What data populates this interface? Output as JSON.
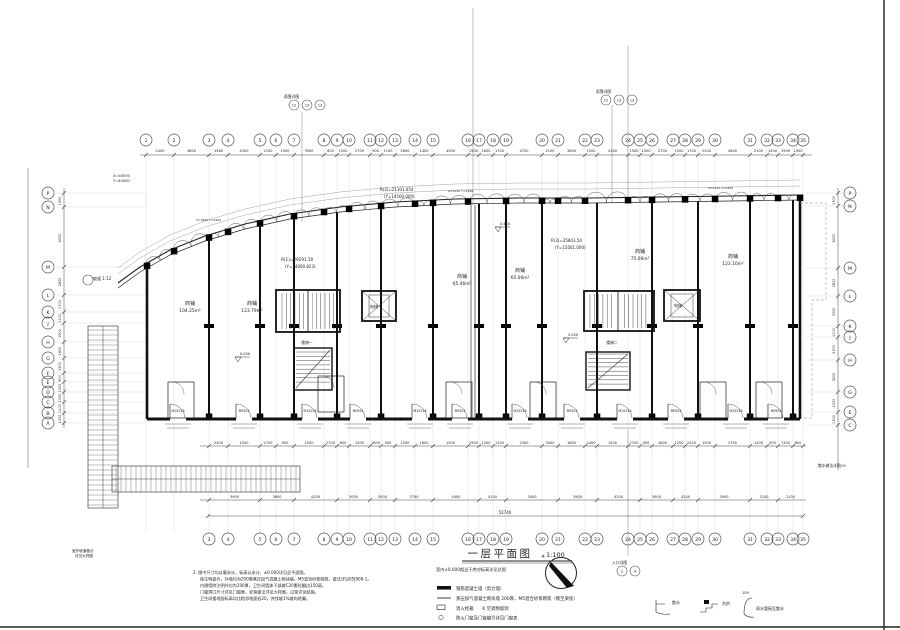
{
  "title": {
    "text": "一层平面图",
    "scale": "1:100",
    "subtitle": "室内±0.000相当于绝对标高详见总图",
    "total_dim": "52740"
  },
  "north": {
    "mark": "✳"
  },
  "grid": {
    "top": [
      {
        "n": "1",
        "x": 146
      },
      {
        "n": "2",
        "x": 174
      },
      {
        "n": "3",
        "x": 209
      },
      {
        "n": "4",
        "x": 228
      },
      {
        "n": "5",
        "x": 260
      },
      {
        "n": "6",
        "x": 276
      },
      {
        "n": "7",
        "x": 294
      },
      {
        "n": "8",
        "x": 324
      },
      {
        "n": "9",
        "x": 337
      },
      {
        "n": "10",
        "x": 349
      },
      {
        "n": "11",
        "x": 370
      },
      {
        "n": "12",
        "x": 381
      },
      {
        "n": "13",
        "x": 395
      },
      {
        "n": "14",
        "x": 415
      },
      {
        "n": "15",
        "x": 433
      },
      {
        "n": "16",
        "x": 468
      },
      {
        "n": "17",
        "x": 479
      },
      {
        "n": "18",
        "x": 493
      },
      {
        "n": "19",
        "x": 506
      },
      {
        "n": "20",
        "x": 542
      },
      {
        "n": "21",
        "x": 558
      },
      {
        "n": "22",
        "x": 585
      },
      {
        "n": "23",
        "x": 597
      },
      {
        "n": "24",
        "x": 628
      },
      {
        "n": "25",
        "x": 640
      },
      {
        "n": "26",
        "x": 652
      },
      {
        "n": "27",
        "x": 673
      },
      {
        "n": "28",
        "x": 685
      },
      {
        "n": "29",
        "x": 698
      },
      {
        "n": "30",
        "x": 715
      },
      {
        "n": "31",
        "x": 750
      },
      {
        "n": "32",
        "x": 767
      },
      {
        "n": "33",
        "x": 778
      },
      {
        "n": "34",
        "x": 793
      },
      {
        "n": "35",
        "x": 803
      }
    ],
    "left": [
      {
        "n": "P",
        "y": 193
      },
      {
        "n": "N",
        "y": 207
      },
      {
        "n": "M",
        "y": 267
      },
      {
        "n": "L",
        "y": 295
      },
      {
        "n": "K",
        "y": 312
      },
      {
        "n": "J",
        "y": 323
      },
      {
        "n": "H",
        "y": 342
      },
      {
        "n": "G",
        "y": 358
      },
      {
        "n": "F",
        "y": 373
      },
      {
        "n": "E",
        "y": 382
      },
      {
        "n": "D",
        "y": 392
      },
      {
        "n": "C",
        "y": 402
      },
      {
        "n": "B",
        "y": 413
      },
      {
        "n": "A",
        "y": 423
      }
    ],
    "right": [
      {
        "n": "P",
        "y": 193
      },
      {
        "n": "N",
        "y": 206
      },
      {
        "n": "M",
        "y": 268
      },
      {
        "n": "L",
        "y": 296
      },
      {
        "n": "K",
        "y": 326
      },
      {
        "n": "J",
        "y": 337
      },
      {
        "n": "H",
        "y": 360
      },
      {
        "n": "G",
        "y": 392
      },
      {
        "n": "E",
        "y": 412
      },
      {
        "n": "C",
        "y": 425
      }
    ]
  },
  "dims": {
    "top": [
      "2400",
      "4800",
      "1560",
      "4300",
      "2100",
      "1500",
      "3900",
      "600",
      "1500",
      "2700",
      "900",
      "1100",
      "2600",
      "1400",
      "4500",
      "1500",
      "1800",
      "1700",
      "4700",
      "2100",
      "3600",
      "1500",
      "4100",
      "1500",
      "1500",
      "2700",
      "1500",
      "1700",
      "2200",
      "4600",
      "2100",
      "1400",
      "1900",
      "1300"
    ],
    "bottom1": [
      "2400",
      "1500",
      "2700",
      "900",
      "1500",
      "2700",
      "600",
      "1200",
      "1800",
      "900",
      "1200",
      "1800",
      "1500",
      "2900",
      "1200",
      "1100",
      "2300",
      "3000",
      "1800",
      "2400",
      "1500",
      "2700",
      "900",
      "1800",
      "1200",
      "2400",
      "1500",
      "2700",
      "1200",
      "900",
      "1300",
      "800"
    ],
    "bottom2": [
      "3900",
      "3600",
      "4200",
      "3000",
      "3000",
      "2700",
      "4400",
      "4100",
      "3400",
      "3900",
      "4200",
      "3900",
      "4200",
      "3900",
      "2100",
      "2100"
    ],
    "left": [
      "1500",
      "6000",
      "2800",
      "1700",
      "1100",
      "1900",
      "1600",
      "1500",
      "900",
      "1000",
      "1000",
      "1100",
      "1000"
    ],
    "right": [
      "1300",
      "6200",
      "2800",
      "3000",
      "1100",
      "2300",
      "3200",
      "2000",
      "1300"
    ]
  },
  "rooms": [
    {
      "name": "商铺",
      "area": "104.25m²",
      "x": 190,
      "y": 305
    },
    {
      "name": "商铺",
      "area": "123.79m²",
      "x": 252,
      "y": 305
    },
    {
      "name": "商铺",
      "area": "65.46m²",
      "x": 462,
      "y": 278
    },
    {
      "name": "商铺",
      "area": "65.06m²",
      "x": 520,
      "y": 272
    },
    {
      "name": "商铺",
      "area": "75.06m²",
      "x": 640,
      "y": 253
    },
    {
      "name": "商铺",
      "area": "123.10m²",
      "x": 733,
      "y": 258
    }
  ],
  "annotations": [
    {
      "t": "R(1)=29291.50",
      "x": 281,
      "y": 261,
      "fs": 4.2
    },
    {
      "t": "(Y=14000.823)",
      "x": 285,
      "y": 268,
      "fs": 4
    },
    {
      "t": "R(2)=21101.054",
      "x": 380,
      "y": 191,
      "fs": 4
    },
    {
      "t": "(Y=14500.000)",
      "x": 384,
      "y": 198,
      "fs": 4
    },
    {
      "t": "R(3)=35843.54",
      "x": 551,
      "y": 242,
      "fs": 4
    },
    {
      "t": "(Y=15001.000)",
      "x": 555,
      "y": 249,
      "fs": 4
    },
    {
      "t": "X=45000",
      "x": 113,
      "y": 177,
      "fs": 3.6
    },
    {
      "t": "Y=40000",
      "x": 113,
      "y": 182,
      "fs": 3.6
    },
    {
      "t": "坡道 1:12",
      "x": 93,
      "y": 280,
      "fs": 4
    },
    {
      "t": "散水做法详图19",
      "x": 818,
      "y": 467,
      "fs": 3.8
    },
    {
      "t": "室外坡道做法",
      "x": 72,
      "y": 552,
      "fs": 3.6
    },
    {
      "t": "详见大样图",
      "x": 75,
      "y": 557,
      "fs": 3.6
    },
    {
      "t": "X=3620 Y=1402",
      "x": 196,
      "y": 221,
      "fs": 3
    },
    {
      "t": "X=4150 Y=1298",
      "x": 448,
      "y": 192,
      "fs": 3
    },
    {
      "t": "X=4722 Y=1260",
      "x": 708,
      "y": 189,
      "fs": 3
    },
    {
      "t": "电梯",
      "x": 374,
      "y": 308,
      "fs": 4,
      "an": "middle"
    },
    {
      "t": "电梯",
      "x": 678,
      "y": 307,
      "fs": 4,
      "an": "middle"
    },
    {
      "t": "楼梯一",
      "x": 307,
      "y": 344,
      "fs": 3.8,
      "an": "middle"
    },
    {
      "t": "楼梯二",
      "x": 612,
      "y": 344,
      "fs": 3.8,
      "an": "middle"
    }
  ],
  "elevations": [
    {
      "v": "0.000",
      "x": 238,
      "y": 360
    },
    {
      "v": "3.000",
      "x": 566,
      "y": 341
    },
    {
      "v": "0.450",
      "x": 498,
      "y": 230
    }
  ],
  "callouts": [
    {
      "label": "雨篷详图",
      "circles": [
        "12",
        "13",
        "13"
      ],
      "x": 288,
      "y": 98
    },
    {
      "label": "雨篷详图",
      "circles": [
        "12",
        "13",
        "13"
      ],
      "x": 600,
      "y": 93
    },
    {
      "label": "入口详图",
      "circles": [
        "2",
        "4"
      ],
      "x": 616,
      "y": 564
    }
  ],
  "doors": {
    "xs": [
      178,
      244,
      310,
      358,
      420,
      460,
      520,
      572,
      625,
      676,
      736,
      776
    ],
    "labels": [
      "M1023A",
      "M0924"
    ]
  },
  "legend": {
    "items": [
      {
        "label": "钢筋混凝土墙（剪力墙）"
      },
      {
        "label": "蒸压加气混凝土砌块墙 200厚，M5混合砂浆砌筑（砌至梁底）"
      },
      {
        "label": "消火栓箱　　K 空调预留洞"
      },
      {
        "label": "防火门窗及门窗编号详见门窗表"
      }
    ]
  },
  "sketches": [
    {
      "label": "散水"
    },
    {
      "label": "台阶"
    },
    {
      "label": "雨水管接至散水",
      "dim": "100"
    }
  ],
  "notes": {
    "lines": [
      "2. 图中尺寸均以毫米计，标高以米计，±0.000详见总平面图。",
      "除注明者外，外墙均为200厚蒸压加气混凝土砌块墙，M5混合砂浆砌筑，做法详见05J909-1。",
      "内隔墙除注明外均为200厚，卫生间墙体下部做C20素砼翻边150高。",
      "门窗洞口尺寸详见门窗表，安装做法详见大样图，过梁详见结施。",
      "卫生间楼地面标高均比相邻地面低20，并找坡1%坡向地漏。"
    ]
  }
}
